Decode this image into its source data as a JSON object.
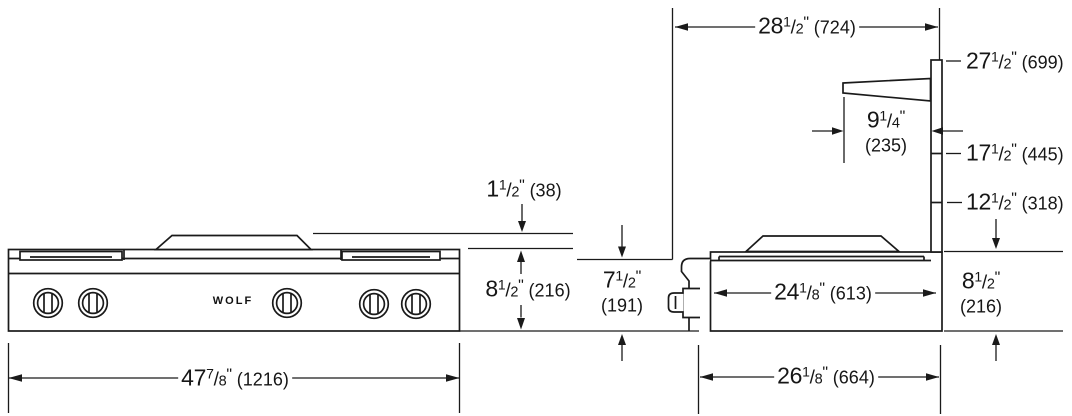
{
  "brand": "WOLF",
  "dims": {
    "back_width": {
      "whole": "28",
      "num": "1",
      "slash": "/",
      "den": "2",
      "inch": "\"",
      "mm": "(724)"
    },
    "riser_top_height": {
      "whole": "27",
      "num": "1",
      "slash": "/",
      "den": "2",
      "inch": "\"",
      "mm": "(699)"
    },
    "shelf_depth": {
      "whole": "9",
      "num": "1",
      "slash": "/",
      "den": "4",
      "inch": "\"",
      "mm": "(235)"
    },
    "riser_mid_height": {
      "whole": "17",
      "num": "1",
      "slash": "/",
      "den": "2",
      "inch": "\"",
      "mm": "(445)"
    },
    "riser_low_height": {
      "whole": "12",
      "num": "1",
      "slash": "/",
      "den": "2",
      "inch": "\"",
      "mm": "(318)"
    },
    "grate_above_counter": {
      "whole": "1",
      "num": "1",
      "slash": "/",
      "den": "2",
      "inch": "\"",
      "mm": "(38)"
    },
    "overall_height": {
      "whole": "8",
      "num": "1",
      "slash": "/",
      "den": "2",
      "inch": "\"",
      "mm": "(216)"
    },
    "below_counter_depth": {
      "whole": "7",
      "num": "1",
      "slash": "/",
      "den": "2",
      "inch": "\"",
      "mm": "(191)"
    },
    "body_depth": {
      "whole": "24",
      "num": "1",
      "slash": "/",
      "den": "8",
      "inch": "\"",
      "mm": "(613)"
    },
    "side_height": {
      "whole": "8",
      "num": "1",
      "slash": "/",
      "den": "2",
      "inch": "\"",
      "mm": "(216)"
    },
    "overall_width": {
      "whole": "47",
      "num": "7",
      "slash": "/",
      "den": "8",
      "inch": "\"",
      "mm": "(1216)"
    },
    "overall_depth": {
      "whole": "26",
      "num": "1",
      "slash": "/",
      "den": "8",
      "inch": "\"",
      "mm": "(664)"
    }
  }
}
